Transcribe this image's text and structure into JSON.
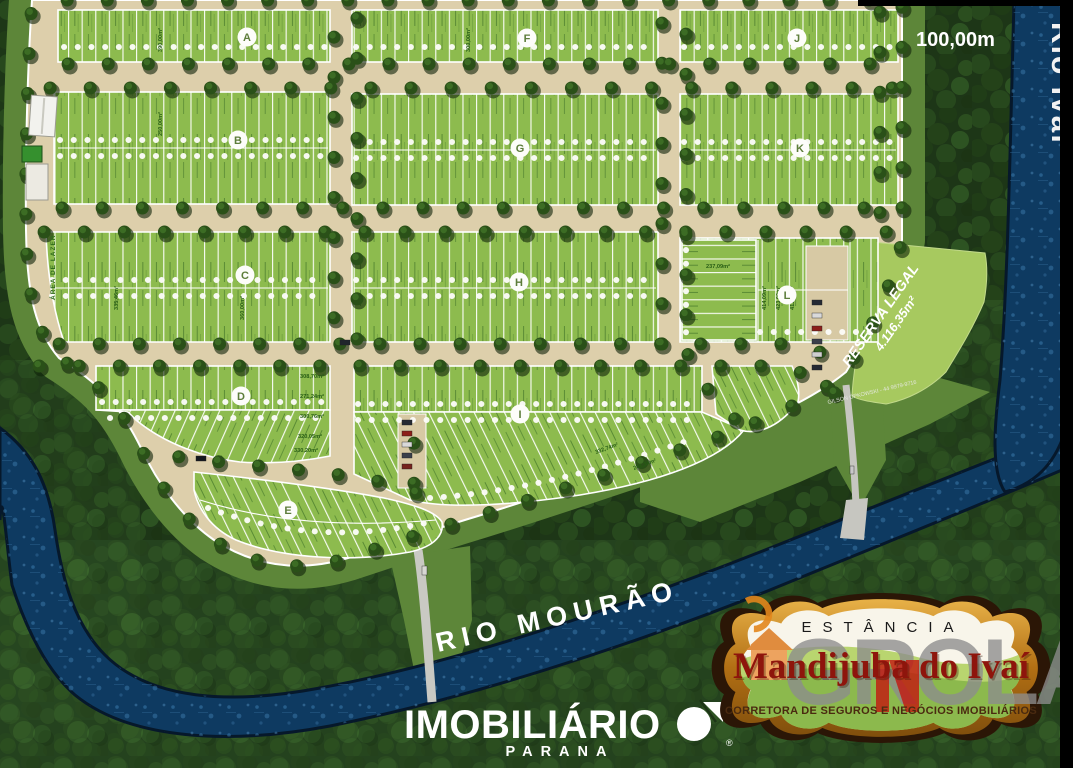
{
  "map": {
    "scale": "100,00m",
    "rivers": {
      "right": "Rio Ivaí",
      "bottom": "RIO MOURÃO"
    },
    "reserve": {
      "title": "RESERVA LEGAL",
      "area": "4.116,35m²"
    },
    "leisure_area": "ÁREA DE LAZER",
    "contact_watermark": "GILSON OPKOWSKI - 44 9979-9716",
    "blocks": [
      {
        "label": "A"
      },
      {
        "label": "B"
      },
      {
        "label": "C"
      },
      {
        "label": "D"
      },
      {
        "label": "E"
      },
      {
        "label": "F"
      },
      {
        "label": "G"
      },
      {
        "label": "H"
      },
      {
        "label": "I"
      },
      {
        "label": "J"
      },
      {
        "label": "K"
      },
      {
        "label": "L"
      }
    ],
    "lot_areas": [
      "390,00m²",
      "360,00m²",
      "250,00m²",
      "300,00m²",
      "308,70m²",
      "271,24m²",
      "300,76m²",
      "320,05m²",
      "330,20m²",
      "237,09m²",
      "414,09m²",
      "423,00m²",
      "412,17m²",
      "335,46m²",
      "241,34m²",
      "332,74m²"
    ]
  },
  "branding": {
    "agency": {
      "name": "IMOBILIÁRIO",
      "region": "PARANA",
      "registered": "®"
    },
    "badge": {
      "estate_type": "ESTÂNCIA",
      "estate_name": "Mandijuba do Ivaí",
      "tagline": "CORRETORA DE SEGUROS E NEGÓCIOS IMOBILIÁRIOS",
      "watermark": "GROLA"
    }
  },
  "colors": {
    "forest": "#1d3617",
    "lot_green": "#8dbb4e",
    "land_beige": "#ddcfab",
    "river_blue": "#0e3a61",
    "reserve_green": "#a7c95f",
    "badge_red": "#8e150c",
    "badge_gold": "#c98a1b",
    "watermark_gray": "#8e8e8e"
  }
}
